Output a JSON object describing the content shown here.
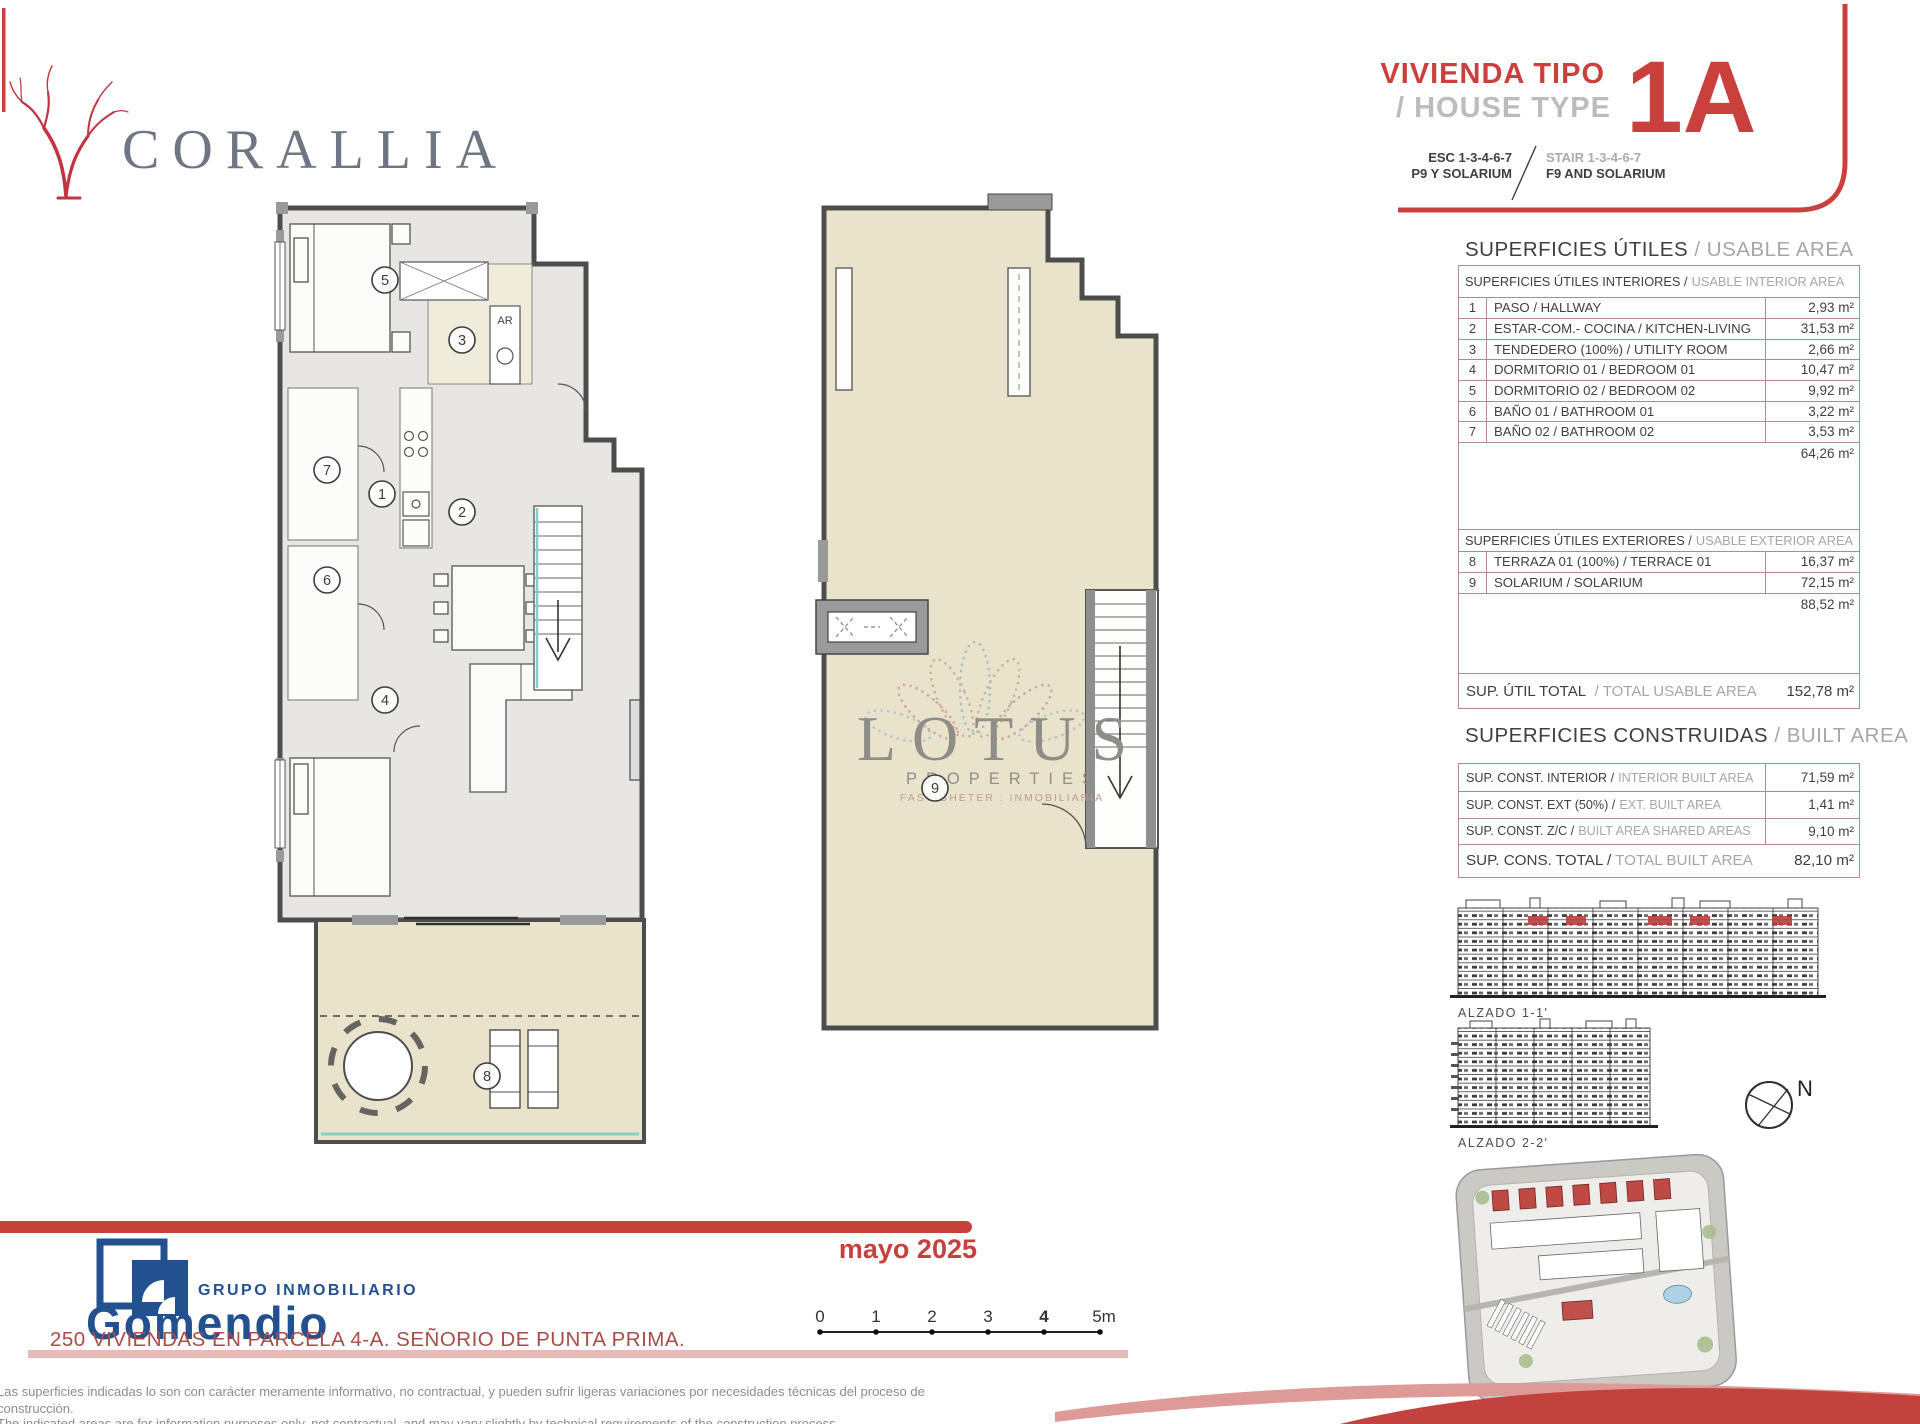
{
  "branding": {
    "corallia": "CORALLIA",
    "lotus": {
      "name": "LOTUS",
      "sub": "PROPERTIES",
      "tagline": "FASTIGHETER : INMOBILIARIA"
    },
    "gomendio": {
      "group": "GRUPO INMOBILIARIO",
      "name": "Gomendio"
    }
  },
  "header": {
    "title_es": "VIVIENDA TIPO",
    "title_en": "/ HOUSE TYPE",
    "esc": "ESC 1-3-4-6-7",
    "stair": "STAIR 1-3-4-6-7",
    "p9": "P9 Y SOLARIUM",
    "f9": "F9 AND SOLARIUM",
    "unit": "1A"
  },
  "usable": {
    "title_es": "SUPERFICIES ÚTILES",
    "title_en": "/ USABLE AREA",
    "interior_header_es": "SUPERFICIES ÚTILES INTERIORES /",
    "interior_header_en": "USABLE INTERIOR AREA",
    "interior_rows": [
      {
        "num": "1",
        "name": "PASO / HALLWAY",
        "value": "2,93 m²"
      },
      {
        "num": "2",
        "name": "ESTAR-COM.- COCINA / KITCHEN-LIVING",
        "value": "31,53 m²"
      },
      {
        "num": "3",
        "name": "TENDEDERO (100%) / UTILITY ROOM",
        "value": "2,66 m²"
      },
      {
        "num": "4",
        "name": "DORMITORIO 01 / BEDROOM 01",
        "value": "10,47 m²"
      },
      {
        "num": "5",
        "name": "DORMITORIO 02 / BEDROOM 02",
        "value": "9,92 m²"
      },
      {
        "num": "6",
        "name": "BAÑO 01 / BATHROOM 01",
        "value": "3,22 m²"
      },
      {
        "num": "7",
        "name": "BAÑO 02 / BATHROOM 02",
        "value": "3,53 m²"
      }
    ],
    "interior_subtotal": "64,26 m²",
    "exterior_header_es": "SUPERFICIES ÚTILES EXTERIORES /",
    "exterior_header_en": "USABLE EXTERIOR AREA",
    "exterior_rows": [
      {
        "num": "8",
        "name": "TERRAZA 01 (100%) / TERRACE 01",
        "value": "16,37 m²"
      },
      {
        "num": "9",
        "name": "SOLARIUM / SOLARIUM",
        "value": "72,15 m²"
      }
    ],
    "exterior_subtotal": "88,52 m²",
    "total_es": "SUP. ÚTIL TOTAL",
    "total_en": "/ TOTAL USABLE AREA",
    "total_value": "152,78 m²"
  },
  "built": {
    "title_es": "SUPERFICIES CONSTRUIDAS",
    "title_en": "/ BUILT AREA",
    "rows": [
      {
        "label_es": "SUP. CONST. INTERIOR /",
        "label_en": "INTERIOR BUILT AREA",
        "value": "71,59 m²"
      },
      {
        "label_es": "SUP. CONST. EXT (50%) /",
        "label_en": "EXT. BUILT AREA",
        "value": "1,41 m²"
      },
      {
        "label_es": "SUP. CONST. Z/C /",
        "label_en": "BUILT AREA SHARED AREAS",
        "value": "9,10 m²"
      },
      {
        "label_es": "SUP. CONS. TOTAL /",
        "label_en": "TOTAL BUILT AREA",
        "value": "82,10 m²"
      }
    ]
  },
  "elevations": {
    "alzado1": "ALZADO 1-1'",
    "alzado2": "ALZADO 2-2'",
    "compass_n": "N"
  },
  "plans": {
    "numbers": [
      "1",
      "2",
      "3",
      "4",
      "5",
      "6",
      "7",
      "8",
      "9"
    ],
    "ar": "AR"
  },
  "footer": {
    "date": "mayo 2025",
    "project": "250 VIVIENDAS EN PARCELA 4-A. SEÑORIO DE PUNTA PRIMA.",
    "scale": [
      "0",
      "1",
      "2",
      "3",
      "4",
      "5m"
    ],
    "disclaimer_es_1": "Las superficies indicadas lo son con carácter meramente informativo, no contractual, y pueden sufrir ligeras variaciones por necesidades técnicas del proceso de",
    "disclaimer_es_2": "construcción.",
    "disclaimer_en": "The indicated areas are for information purposes only, not contractual, and may vary slightly by technical requirements of the construction process."
  },
  "colors": {
    "accent_red": "#c9403d",
    "table_border": "#b38989",
    "plan_wall": "#4d4d4d",
    "terrace_tan": "#eae3cc",
    "glass_teal": "#86ccc8",
    "gomendio_blue": "#23508f",
    "watermark_gray": "#8e8d88"
  }
}
